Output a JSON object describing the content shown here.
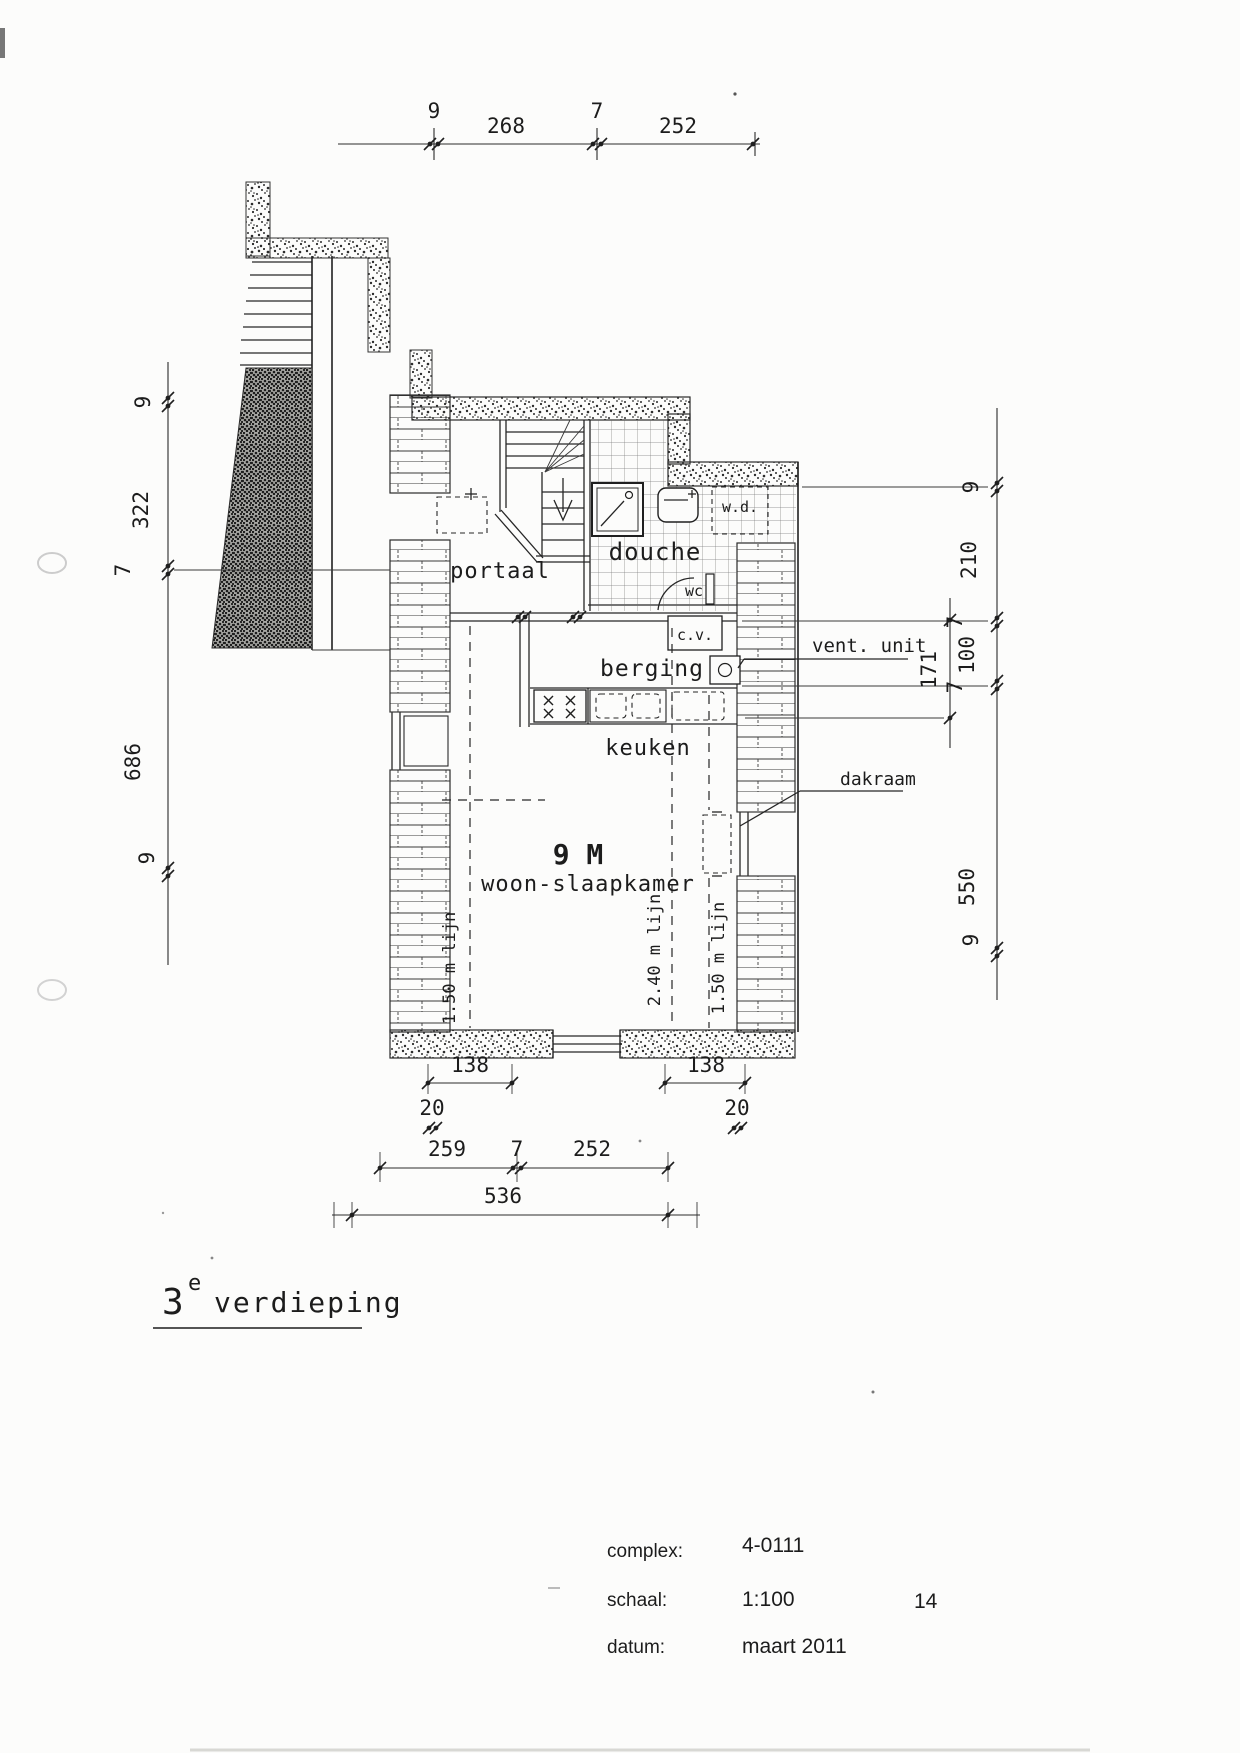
{
  "colors": {
    "ink": "#222222",
    "paper": "#fcfcfb"
  },
  "dimensions": {
    "top_chain": [
      "9",
      "268",
      "7",
      "252"
    ],
    "left_chain": [
      "9",
      "322",
      "7",
      "686",
      "9"
    ],
    "right_chain": [
      "9",
      "210",
      "7",
      "100",
      "7",
      "550",
      "9"
    ],
    "right_inner": "171",
    "window_left": "138",
    "window_right": "138",
    "offset_left": "20",
    "offset_right": "20",
    "bottom_chain": [
      "259",
      "7",
      "252"
    ],
    "bottom_total": "536"
  },
  "rooms": {
    "portaal": "portaal",
    "douche": "douche",
    "wc": "wc",
    "washer_dryer": "w.d.",
    "cv": "c.v.",
    "berging": "berging",
    "keuken": "keuken",
    "area_label": "9 M",
    "living": "woon-slaapkamer"
  },
  "annotations": {
    "vent_unit": "vent. unit",
    "dakraam": "dakraam",
    "height_line_left": "1.50 m lijn",
    "height_line_mid": "2.40 m lijn",
    "height_line_right": "1.50 m lijn"
  },
  "title": {
    "floor_number": "3",
    "floor_sup": "e",
    "floor_name": "verdieping"
  },
  "footer": {
    "complex_label": "complex:",
    "complex_value": "4-0111",
    "scale_label": "schaal:",
    "scale_value": "1:100",
    "date_label": "datum:",
    "date_value": "maart 2011",
    "page_number": "14"
  }
}
